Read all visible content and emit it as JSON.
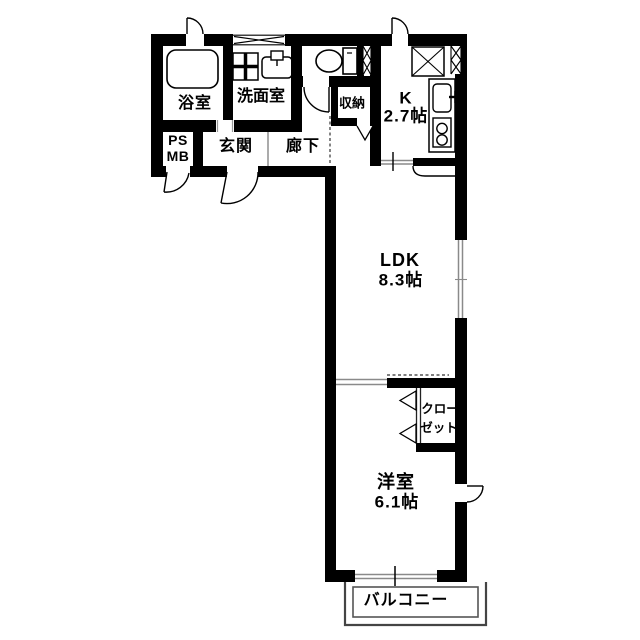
{
  "floorplan": {
    "type": "apartment-floorplan",
    "colors": {
      "wall": "#000000",
      "background": "#ffffff",
      "window_line": "#8a8a8a",
      "balcony_line": "#555555"
    },
    "rooms": {
      "bathroom": {
        "label": "浴室"
      },
      "washroom": {
        "label": "洗面室"
      },
      "pipe_space": {
        "line1": "PS",
        "line2": "MB"
      },
      "entrance": {
        "label": "玄関"
      },
      "hallway": {
        "label": "廊下"
      },
      "storage": {
        "label": "収納"
      },
      "kitchen": {
        "label": "K",
        "size": "2.7帖"
      },
      "ldk": {
        "label": "LDK",
        "size": "8.3帖"
      },
      "closet": {
        "line1": "クロー",
        "line2": "ゼット"
      },
      "western_room": {
        "label": "洋室",
        "size": "6.1帖"
      },
      "balcony": {
        "label": "バルコニー"
      }
    },
    "icons": [
      "bathtub-icon",
      "washing-machine-pan-icon",
      "washbasin-icon",
      "toilet-icon",
      "refrigerator-icon",
      "kitchen-sink-icon",
      "faucet-icon",
      "gas-stove-icon",
      "pipe-shaft-x-icon",
      "window-x-icon",
      "door-swing-icon",
      "sliding-door-icon",
      "folding-door-icon"
    ]
  }
}
